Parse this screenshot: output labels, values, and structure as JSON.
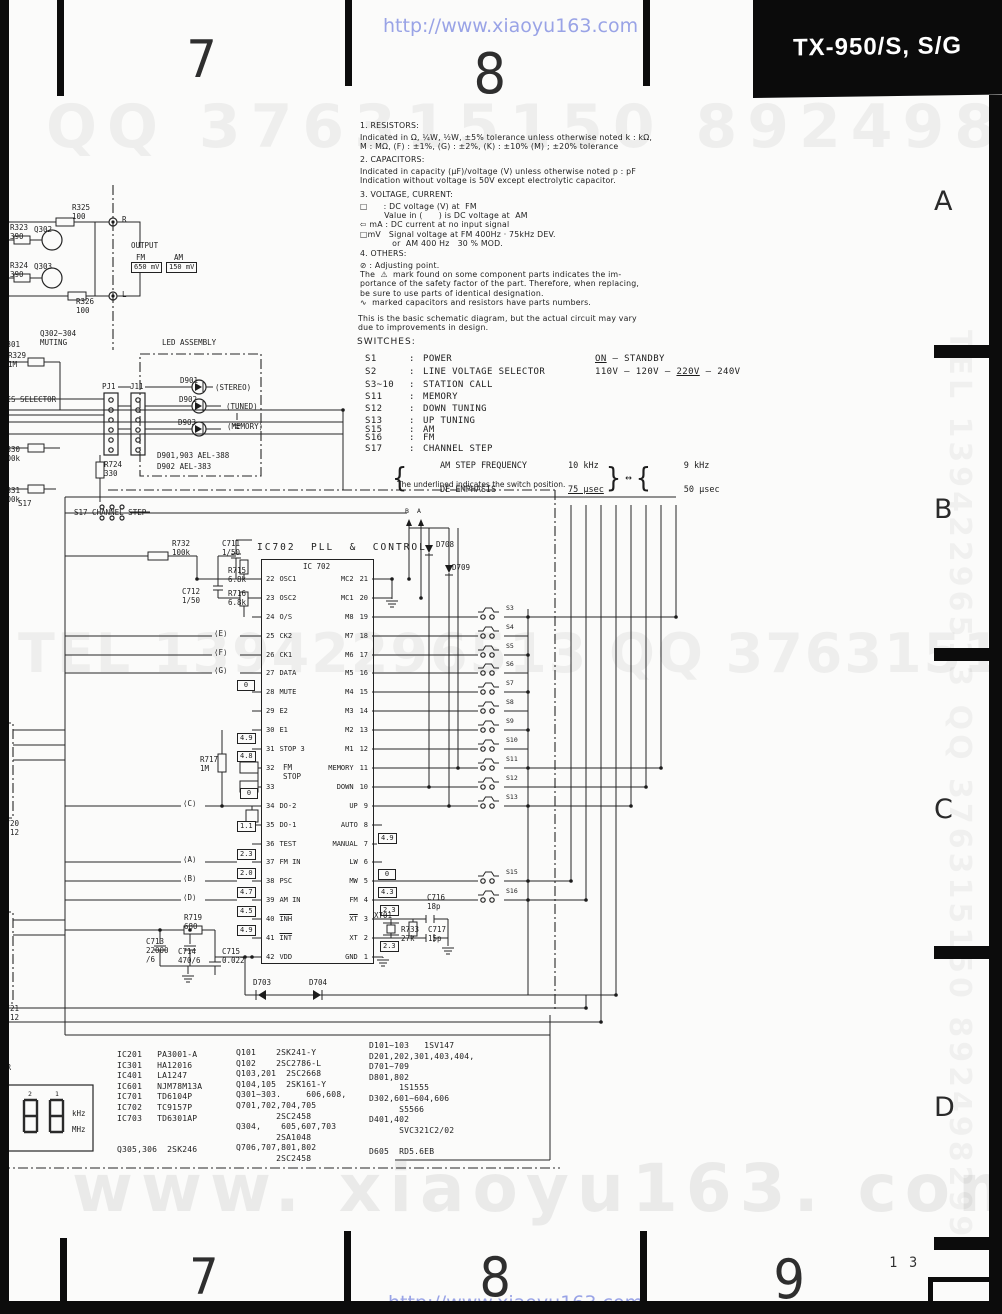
{
  "header": {
    "page_left": "7",
    "page_center": "8",
    "title": "TX-950/S, S/G",
    "url": "http://www.xiaoyu163.com"
  },
  "footer": {
    "page_left": "7",
    "page_center": "8",
    "page_right": "9",
    "page_small": "1 3",
    "url": "http://www.xiaoyu163.com"
  },
  "watermarks": {
    "qq": "QQ 376315150      892498299",
    "tel": "TEL 13942296513  QQ 376315150  892498299",
    "site": "www. xiaoyu163. com",
    "tel_vertical": "TEL 13942296513  QQ 376315150  892498299"
  },
  "section_letters": [
    {
      "t": "A",
      "y": 188
    },
    {
      "t": "B",
      "y": 496
    },
    {
      "t": "C",
      "y": 796
    },
    {
      "t": "D",
      "y": 1094
    }
  ],
  "notes": {
    "colon": ":",
    "s1": {
      "title": "1. RESISTORS:",
      "lines": [
        "Indicated in Ω, ¼W, ½W, ±5% tolerance unless otherwise noted k : kΩ,",
        "M : MΩ, (F) : ±1%, (G) : ±2%, (K) : ±10% (M) ; ±20% tolerance"
      ]
    },
    "s2": {
      "title": "2. CAPACITORS:",
      "lines": [
        "Indicated in capacity (μF)/voltage (V) unless otherwise noted p : pF",
        "Indication without voltage is 50V except electrolytic capacitor."
      ]
    },
    "s3": {
      "title": "3. VOLTAGE, CURRENT:",
      "lines": [
        "□      : DC voltage (V) at  FM",
        "         Value in (      ) is DC voltage at  AM",
        "⇦ mA : DC current at no input signal",
        "□mV   Signal voltage at FM 400Hz · 75kHz DEV.",
        "            or  AM 400 Hz   30 % MOD."
      ]
    },
    "s4": {
      "title": "4. OTHERS:",
      "lines": [
        "⊘ : Adjusting point.",
        "The  ⚠  mark found on some component parts indicates the im-",
        "portance of the safety factor of the part. Therefore, when replacing,",
        "be sure to use parts of identical designation.",
        "∿  marked capacitors and resistors have parts numbers."
      ]
    },
    "disclaimer": [
      "This is the basic schematic diagram, but the actual circuit may vary",
      "due to improvements in design."
    ],
    "switches_title": "SWITCHES:",
    "switches": [
      {
        "id": "S1",
        "label": "POWER",
        "pre": "",
        "u": "ON",
        "post": " — STANDBY",
        "y": 354
      },
      {
        "id": "S2",
        "label": "LINE VOLTAGE SELECTOR",
        "pre": "110V – 120V – ",
        "u": "220V",
        "post": " – 240V",
        "y": 367
      },
      {
        "id": "S3~10",
        "label": "STATION CALL",
        "pre": "",
        "u": "",
        "post": "",
        "y": 380
      },
      {
        "id": "S11",
        "label": "MEMORY",
        "pre": "",
        "u": "",
        "post": "",
        "y": 392
      },
      {
        "id": "S12",
        "label": "DOWN TUNING",
        "pre": "",
        "u": "",
        "post": "",
        "y": 404
      },
      {
        "id": "S13",
        "label": "UP TUNING",
        "pre": "",
        "u": "",
        "post": "",
        "y": 416
      },
      {
        "id": "S15",
        "label": "AM",
        "pre": "",
        "u": "",
        "post": "",
        "y": 425
      },
      {
        "id": "S16",
        "label": "FM",
        "pre": "",
        "u": "",
        "post": "",
        "y": 433
      },
      {
        "id": "S17",
        "label": "CHANNEL STEP",
        "pre": "",
        "u": "",
        "post": "",
        "y": 444
      }
    ],
    "channel_step": {
      "r1_name": "AM STEP FREQUENCY",
      "r1_val": "10 kHz",
      "r2_name": "DE-EMPHASIS",
      "r2_val": "75 μsec",
      "alt1": "9 kHz",
      "alt2": "50 μsec",
      "brace_open": "{",
      "brace_close": "}",
      "arrow": "↔"
    },
    "underline_note": "The underlined indicates the switch position."
  },
  "schematic": {
    "left_pins": [
      {
        "n": "22",
        "nm": "OSC1",
        "y": 579
      },
      {
        "n": "23",
        "nm": "OSC2",
        "y": 598
      },
      {
        "n": "24",
        "nm": "O/S",
        "y": 617
      },
      {
        "n": "25",
        "nm": "CK2",
        "y": 636
      },
      {
        "n": "26",
        "nm": "CK1",
        "y": 655
      },
      {
        "n": "27",
        "nm": "DATA",
        "y": 673
      },
      {
        "n": "28",
        "nm": "MUTE",
        "y": 692
      },
      {
        "n": "29",
        "nm": "E2",
        "y": 711
      },
      {
        "n": "30",
        "nm": "E1",
        "y": 730
      },
      {
        "n": "31",
        "nm": "STOP 3",
        "y": 749
      },
      {
        "n": "32",
        "nm": "",
        "y": 768
      },
      {
        "n": "33",
        "nm": "",
        "y": 787
      },
      {
        "n": "34",
        "nm": "DO-2",
        "y": 806
      },
      {
        "n": "35",
        "nm": "DO-1",
        "y": 825
      },
      {
        "n": "36",
        "nm": "TEST",
        "y": 844
      },
      {
        "n": "37",
        "nm": "FM IN",
        "y": 862
      },
      {
        "n": "38",
        "nm": "PSC",
        "y": 881
      },
      {
        "n": "39",
        "nm": "AM IN",
        "y": 900
      },
      {
        "n": "40",
        "nm": "INH",
        "y": 919,
        "cls": "bar"
      },
      {
        "n": "41",
        "nm": "INT",
        "y": 938,
        "cls": "bar"
      },
      {
        "n": "42",
        "nm": "VDD",
        "y": 957
      }
    ],
    "right_pins": [
      {
        "nm": "MC2",
        "n": "21",
        "y": 579
      },
      {
        "nm": "MC1",
        "n": "20",
        "y": 598
      },
      {
        "nm": "M8",
        "n": "19",
        "y": 617
      },
      {
        "nm": "M7",
        "n": "18",
        "y": 636
      },
      {
        "nm": "M6",
        "n": "17",
        "y": 655
      },
      {
        "nm": "M5",
        "n": "16",
        "y": 673
      },
      {
        "nm": "M4",
        "n": "15",
        "y": 692
      },
      {
        "nm": "M3",
        "n": "14",
        "y": 711
      },
      {
        "nm": "M2",
        "n": "13",
        "y": 730
      },
      {
        "nm": "M1",
        "n": "12",
        "y": 749
      },
      {
        "nm": "MEMORY",
        "n": "11",
        "y": 768
      },
      {
        "nm": "DOWN",
        "n": "10",
        "y": 787
      },
      {
        "nm": "UP",
        "n": "9",
        "y": 806
      },
      {
        "nm": "AUTO",
        "n": "8",
        "y": 825
      },
      {
        "nm": "MANUAL",
        "n": "7",
        "y": 844
      },
      {
        "nm": "LW",
        "n": "6",
        "y": 862
      },
      {
        "nm": "MW",
        "n": "5",
        "y": 881
      },
      {
        "nm": "FM",
        "n": "4",
        "y": 900
      },
      {
        "nm": "XT",
        "n": "3",
        "y": 919,
        "cls": "bar"
      },
      {
        "nm": "XT",
        "n": "2",
        "y": 938
      },
      {
        "nm": "GND",
        "n": "1",
        "y": 957
      }
    ],
    "vboxes": [
      {
        "t": "650 mV",
        "x": 131,
        "y": 262
      },
      {
        "t": "150 mV",
        "x": 166,
        "y": 262
      },
      {
        "t": "0",
        "x": 237,
        "y": 680
      },
      {
        "t": "4.9",
        "x": 237,
        "y": 733
      },
      {
        "t": "4.8",
        "x": 237,
        "y": 751
      },
      {
        "t": "0",
        "x": 240,
        "y": 788
      },
      {
        "t": "1.1",
        "x": 237,
        "y": 821
      },
      {
        "t": "2.3",
        "x": 237,
        "y": 849
      },
      {
        "t": "2.0",
        "x": 237,
        "y": 868
      },
      {
        "t": "4.7",
        "x": 237,
        "y": 887
      },
      {
        "t": "4.5",
        "x": 237,
        "y": 906
      },
      {
        "t": "4.9",
        "x": 237,
        "y": 925
      },
      {
        "t": "4.9",
        "x": 378,
        "y": 833
      },
      {
        "t": "0",
        "x": 378,
        "y": 869
      },
      {
        "t": "4.3",
        "x": 378,
        "y": 887
      },
      {
        "t": "2.3",
        "x": 380,
        "y": 905
      },
      {
        "t": "2.3",
        "x": 380,
        "y": 941
      }
    ],
    "switches": [
      {
        "id": "S3",
        "y": 604
      },
      {
        "id": "S4",
        "y": 623
      },
      {
        "id": "S5",
        "y": 642
      },
      {
        "id": "S6",
        "y": 660
      },
      {
        "id": "S7",
        "y": 679
      },
      {
        "id": "S8",
        "y": 698
      },
      {
        "id": "S9",
        "y": 717
      },
      {
        "id": "S10",
        "y": 736
      },
      {
        "id": "S11",
        "y": 755
      },
      {
        "id": "S12",
        "y": 774
      },
      {
        "id": "S13",
        "y": 793
      },
      {
        "id": "S15",
        "y": 868
      },
      {
        "id": "S16",
        "y": 887
      }
    ],
    "labels": [
      {
        "t": "R323\n390",
        "x": 10,
        "y": 224
      },
      {
        "t": "Q302",
        "x": 34,
        "y": 226
      },
      {
        "t": "R325\n100",
        "x": 72,
        "y": 204
      },
      {
        "t": "R",
        "x": 122,
        "y": 216
      },
      {
        "t": "OUTPUT",
        "x": 131,
        "y": 242
      },
      {
        "t": "FM",
        "x": 136,
        "y": 254
      },
      {
        "t": "AM",
        "x": 174,
        "y": 254
      },
      {
        "t": "R324\n390",
        "x": 10,
        "y": 262
      },
      {
        "t": "Q303",
        "x": 34,
        "y": 263
      },
      {
        "t": "R326\n100",
        "x": 76,
        "y": 298
      },
      {
        "t": "L",
        "x": 122,
        "y": 291
      },
      {
        "t": "Q302~304\nMUTING",
        "x": 40,
        "y": 330
      },
      {
        "t": "D301",
        "x": 2,
        "y": 341
      },
      {
        "t": "R329\n1M",
        "x": 8,
        "y": 352
      },
      {
        "t": "SIS SELECTOR",
        "x": 2,
        "y": 396
      },
      {
        "t": "R330\n100k",
        "x": 2,
        "y": 446
      },
      {
        "t": "R331\n100k",
        "x": 2,
        "y": 487
      },
      {
        "t": "S17",
        "x": 18,
        "y": 500
      },
      {
        "t": "S17  CHANNEL STEP",
        "x": 74,
        "y": 509
      },
      {
        "t": "R724\n330",
        "x": 104,
        "y": 461
      },
      {
        "t": "LED ASSEMBLY",
        "x": 162,
        "y": 339
      },
      {
        "t": "PJ1",
        "x": 102,
        "y": 383
      },
      {
        "t": "J11",
        "x": 130,
        "y": 383
      },
      {
        "t": "D901",
        "x": 180,
        "y": 377
      },
      {
        "t": "(STEREO)",
        "x": 215,
        "y": 384
      },
      {
        "t": "D902",
        "x": 179,
        "y": 396
      },
      {
        "t": "(TUNED)",
        "x": 226,
        "y": 403
      },
      {
        "t": "D903",
        "x": 178,
        "y": 419
      },
      {
        "t": "(MEMORY)",
        "x": 227,
        "y": 423
      },
      {
        "t": "D901,903   AEL-388",
        "x": 157,
        "y": 452
      },
      {
        "t": "D902       AEL-383",
        "x": 157,
        "y": 463
      },
      {
        "t": "R732\n100k",
        "x": 172,
        "y": 540
      },
      {
        "t": "C711\n1/50",
        "x": 222,
        "y": 540
      },
      {
        "t": "R715\n6.8k",
        "x": 228,
        "y": 567
      },
      {
        "t": "C712\n1/50",
        "x": 182,
        "y": 588
      },
      {
        "t": "R716\n6.8k",
        "x": 228,
        "y": 590
      },
      {
        "t": "IC702  PLL  &  CONTROL",
        "x": 257,
        "y": 544,
        "cls": "hd"
      },
      {
        "t": "IC 702",
        "x": 303,
        "y": 563
      },
      {
        "t": "FM\nSTOP",
        "x": 283,
        "y": 764
      },
      {
        "t": "R717\n1M",
        "x": 200,
        "y": 756
      },
      {
        "t": "R719\n680",
        "x": 184,
        "y": 914
      },
      {
        "t": "C713\n22000\n/6",
        "x": 146,
        "y": 938
      },
      {
        "t": "C714\n470/6",
        "x": 178,
        "y": 948
      },
      {
        "t": "C715\n0.022",
        "x": 222,
        "y": 948
      },
      {
        "t": "X701",
        "x": 374,
        "y": 912
      },
      {
        "t": "R733\n27k",
        "x": 401,
        "y": 926
      },
      {
        "t": "C716\n18p",
        "x": 427,
        "y": 894
      },
      {
        "t": "C717\n15p",
        "x": 428,
        "y": 926
      },
      {
        "t": "D703",
        "x": 253,
        "y": 979
      },
      {
        "t": "D704",
        "x": 309,
        "y": 979
      },
      {
        "t": "D708",
        "x": 436,
        "y": 541
      },
      {
        "t": "D709",
        "x": 452,
        "y": 564
      },
      {
        "t": "B",
        "x": 405,
        "y": 507,
        "cls": "sm"
      },
      {
        "t": "A",
        "x": 417,
        "y": 507,
        "cls": "sm"
      },
      {
        "t": "⟨E⟩",
        "x": 214,
        "y": 630
      },
      {
        "t": "⟨F⟩",
        "x": 214,
        "y": 649
      },
      {
        "t": "⟨G⟩",
        "x": 214,
        "y": 667
      },
      {
        "t": "⟨C⟩",
        "x": 183,
        "y": 800
      },
      {
        "t": "⟨A⟩",
        "x": 183,
        "y": 856
      },
      {
        "t": "⟨B⟩",
        "x": 183,
        "y": 875
      },
      {
        "t": "⟨D⟩",
        "x": 183,
        "y": 894
      },
      {
        "t": "R720\nx 12",
        "x": 1,
        "y": 820
      },
      {
        "t": "R721\nx 12",
        "x": 1,
        "y": 1005
      },
      {
        "t": "ER",
        "x": 2,
        "y": 1064
      },
      {
        "t": "2",
        "x": 28,
        "y": 1090,
        "cls": "sm"
      },
      {
        "t": "1",
        "x": 55,
        "y": 1090,
        "cls": "sm"
      },
      {
        "t": "kHz",
        "x": 72,
        "y": 1110
      },
      {
        "t": "MHz",
        "x": 72,
        "y": 1126
      }
    ],
    "parts": {
      "col1": [
        "IC201   PA3001-A",
        "IC301   HA12016",
        "IC401   LA1247",
        "IC601   NJM78M13A",
        "IC701   TD6104P",
        "IC702   TC9157P",
        "IC703   TD6301AP",
        "",
        "",
        "Q305,306  2SK246"
      ],
      "col2": [
        "Q101    2SK241-Y",
        "Q102    2SC2786-L",
        "Q103,201  2SC2668",
        "Q104,105  2SK161-Y",
        "Q301~303.     606,608,",
        "Q701,702,704,705",
        "        2SC2458",
        "Q304,    605,607,703",
        "        2SA1048",
        "Q706,707,801,802",
        "        2SC2458"
      ],
      "col3": [
        "D101~103   1SV147",
        "D201,202,301,403,404,",
        "D701~709",
        "D801,802",
        "      1S1555",
        "D302,601~604,606",
        "      S5566",
        "D401,402",
        "      SVC321C2/02",
        "",
        "D605  RD5.6EB"
      ]
    }
  }
}
